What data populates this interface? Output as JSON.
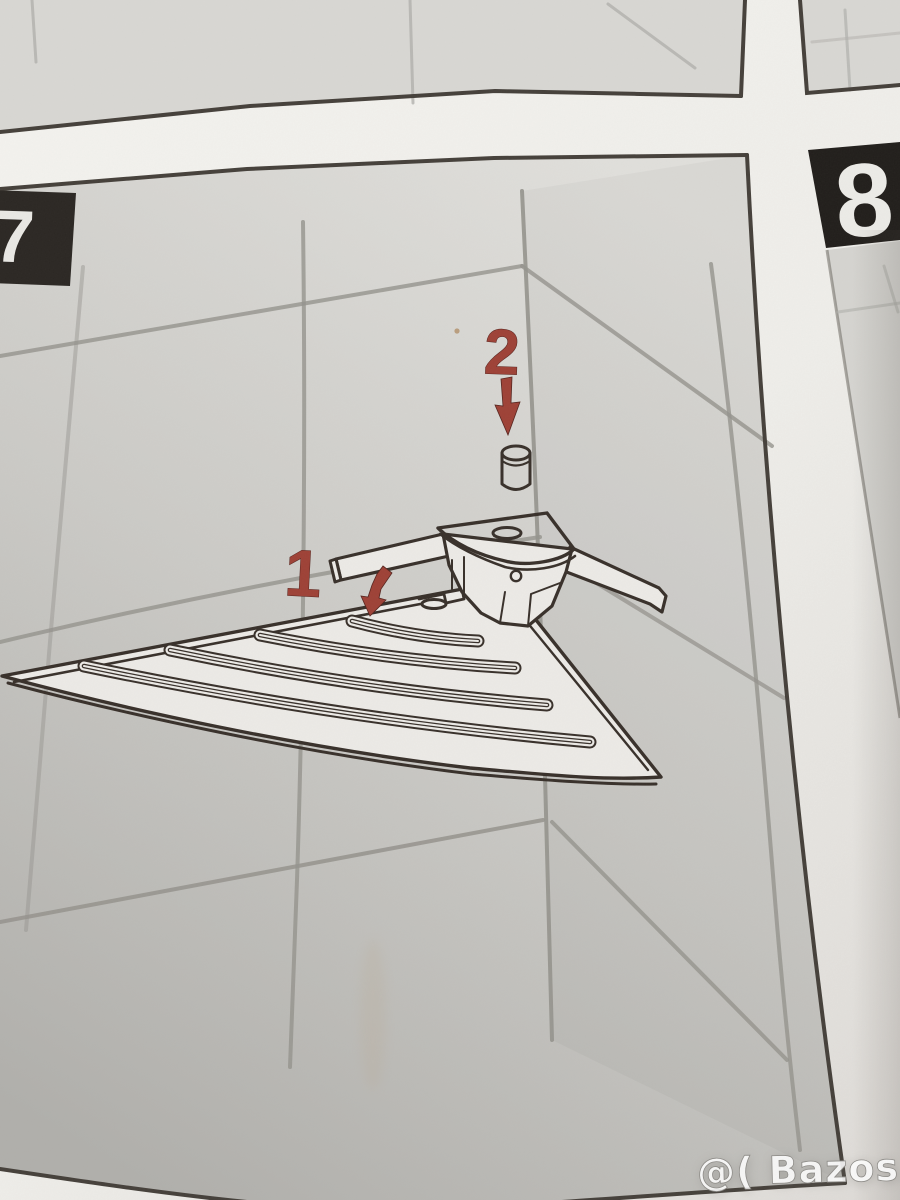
{
  "sheet": {
    "step_current": "7",
    "step_next": "8",
    "callout_1": "1",
    "callout_2": "2"
  },
  "watermark": {
    "text": "@( Bazos.sk"
  },
  "colors": {
    "callout_red": "#9e4136",
    "step_label_bg": "#262220",
    "step_label_text": "#eceae6",
    "line_art": "#38302a",
    "tile_grout": "#95938d",
    "paper": "#f2f1ed",
    "wall_dark": "#b0afab"
  }
}
